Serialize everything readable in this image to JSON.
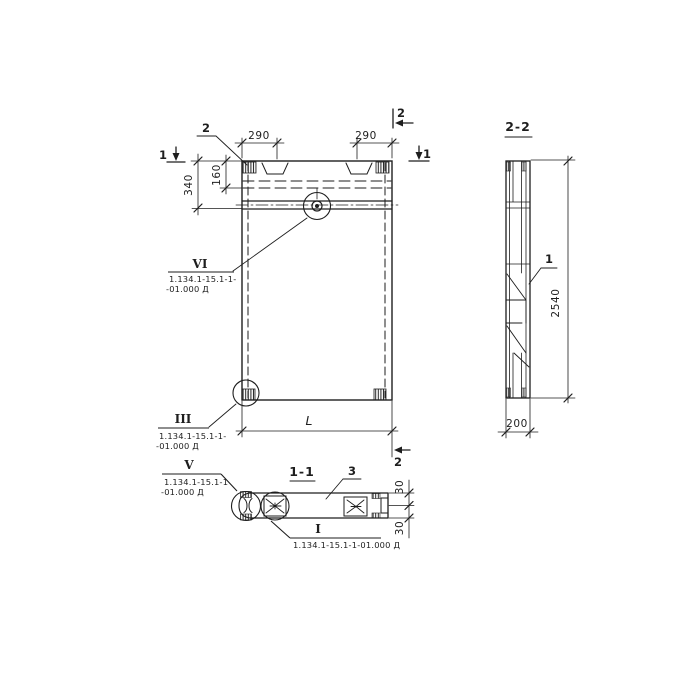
{
  "meta": {
    "background": "#ffffff",
    "ink": "#1e1e1e",
    "drawing_type": "precast concrete panel working drawing"
  },
  "elevation": {
    "callout2": "2",
    "mark1_left": "1",
    "mark1_right": "1",
    "mark2_top": "2",
    "mark2_bottom": "2",
    "dim_290_left": "290",
    "dim_290_right": "290",
    "dim_340": "340",
    "dim_160": "160",
    "dim_L": "L"
  },
  "section22": {
    "title": "2-2",
    "callout1": "1",
    "dim_height": "2540",
    "dim_width": "200"
  },
  "section11": {
    "title": "1-1",
    "callout3": "3",
    "dim_30_top": "30",
    "dim_30_bottom": "30"
  },
  "details": {
    "vi": {
      "numeral": "VI",
      "code1": "1.134.1-15.1-1-",
      "code2": "-01.000 Д"
    },
    "iii": {
      "numeral": "III",
      "code1": "1.134.1-15.1-1-",
      "code2": "-01.000 Д"
    },
    "v": {
      "numeral": "V",
      "code1": "1.134.1-15.1-1",
      "code2": "-01.000 Д"
    },
    "i": {
      "numeral": "I",
      "code1": "1.134.1-15.1-1-01.000 Д"
    }
  }
}
